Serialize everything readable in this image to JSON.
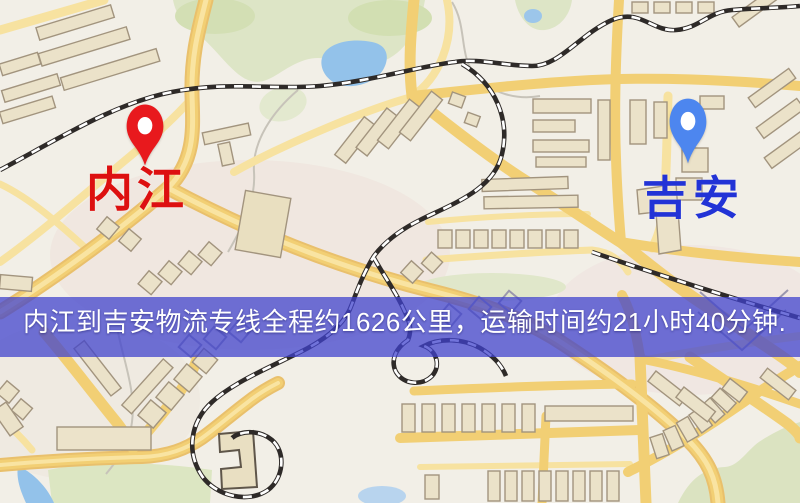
{
  "map": {
    "origin": {
      "name": "内江",
      "pin_color": "#e8191d",
      "label_color": "#dd1010"
    },
    "destination": {
      "name": "吉安",
      "pin_color": "#4d86ef",
      "label_color": "#2233d6"
    }
  },
  "banner": {
    "text": "内江到吉安物流专线全程约1626公里，运输时间约21小时40分钟.",
    "distance_text": "约1626公里",
    "duration_text": "约21小时40分钟",
    "background_color": "rgba(64,66,205,0.74)",
    "text_color": "#ffffff"
  }
}
